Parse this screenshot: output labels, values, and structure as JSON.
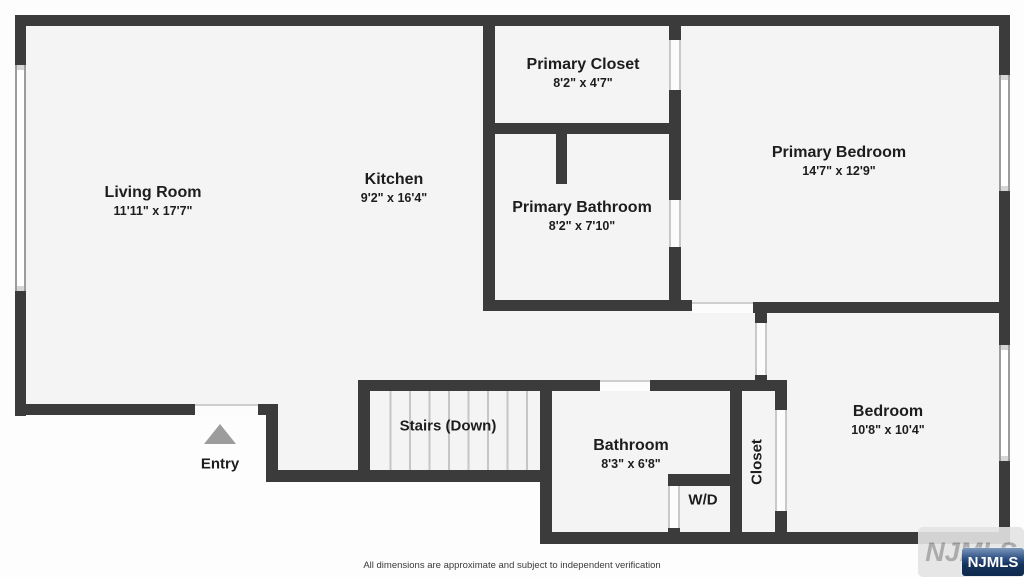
{
  "rooms": [
    {
      "name": "Living Room",
      "dims": "11'11\" x 17'7\""
    },
    {
      "name": "Kitchen",
      "dims": "9'2\" x 16'4\""
    },
    {
      "name": "Primary Closet",
      "dims": "8'2\" x 4'7\""
    },
    {
      "name": "Primary Bathroom",
      "dims": "8'2\" x 7'10\""
    },
    {
      "name": "Primary Bedroom",
      "dims": "14'7\" x 12'9\""
    },
    {
      "name": "Bedroom",
      "dims": "10'8\" x 10'4\""
    },
    {
      "name": "Bathroom",
      "dims": "8'3\" x 6'8\""
    }
  ],
  "features": {
    "stairs": "Stairs (Down)",
    "washer_dryer": "W/D",
    "closet": "Closet",
    "entry": "Entry"
  },
  "icons": {
    "entry_arrow": "triangle-up-icon"
  },
  "footer": {
    "disclaimer": "All dimensions are approximate and subject to independent verification"
  },
  "watermark": {
    "ghost_label": "NJMLS",
    "badge_label": "NJMLS"
  },
  "colors": {
    "wall": "#3b3b3b",
    "floor": "#f4f4f4",
    "background": "#fdfdfd",
    "badge_blue": "#1d3e6d",
    "entry_arrow_gray": "#9c9c9c",
    "tread_line": "#c6c6c6"
  }
}
